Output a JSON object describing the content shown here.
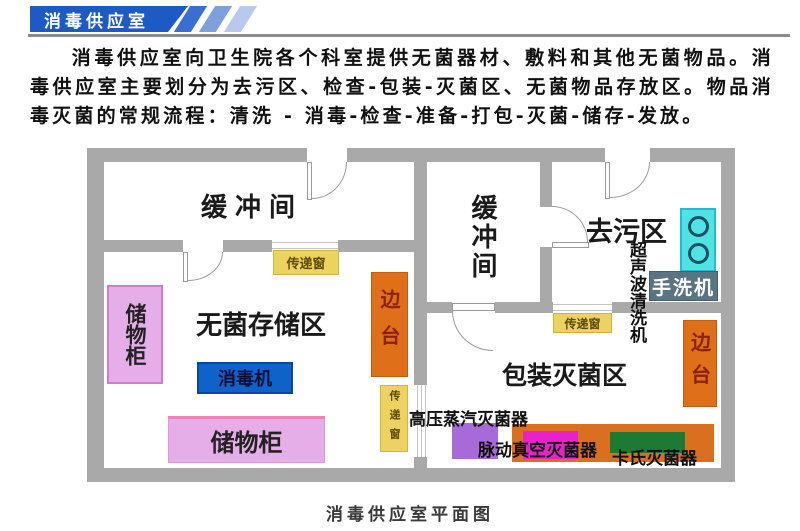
{
  "header": {
    "title": "消毒供应室"
  },
  "intro": {
    "text": "消毒供应室向卫生院各个科室提供无菌器材、敷料和其他无菌物品。消毒供应室主要划分为去污区、检查-包装-灭菌区、无菌物品存放区。物品消毒灭菌的常规流程：清洗 - 消毒-检查-准备-打包-灭菌-储存-发放。"
  },
  "plan": {
    "caption": "消毒供应室平面图",
    "rooms": {
      "buffer_left": "缓冲间",
      "buffer_mid": "缓冲间",
      "decontamination": "去污区",
      "sterile_storage": "无菌存储区",
      "packing_sterilization": "包装灭菌区"
    },
    "equipment": {
      "cabinet_left": "储物柜",
      "cabinet_bottom": "储物柜",
      "disinfector": "消毒机",
      "side_table_left": "边台",
      "side_table_right": "边台",
      "pass_window_top": "传递窗",
      "pass_window_mid": "传递窗",
      "pass_window_right": "传递窗",
      "ultrasonic_cleaner": "超声波清洗机",
      "hand_washer": "手洗机",
      "steam_sterilizer": "高压蒸汽灭菌器",
      "vacuum_sterilizer": "脉动真空灭菌器",
      "cassette_sterilizer": "卡氏灭菌器"
    },
    "colors": {
      "wall": "#a9a9a9",
      "banner_blue": "#1e5ac4",
      "cabinet_pink": "#e6aee8",
      "disinfector_blue": "#0f62c7",
      "side_table_orange": "#df6f18",
      "pass_window_yellow": "#eed261",
      "sink_cyan": "#4fe3e6",
      "hand_washer_slate": "#5b7482",
      "sterilizer_purple": "#a869d9",
      "sterilizer_orange": "#d96f1f",
      "sterilizer_magenta": "#e921c9",
      "sterilizer_green": "#1d7a35"
    }
  }
}
